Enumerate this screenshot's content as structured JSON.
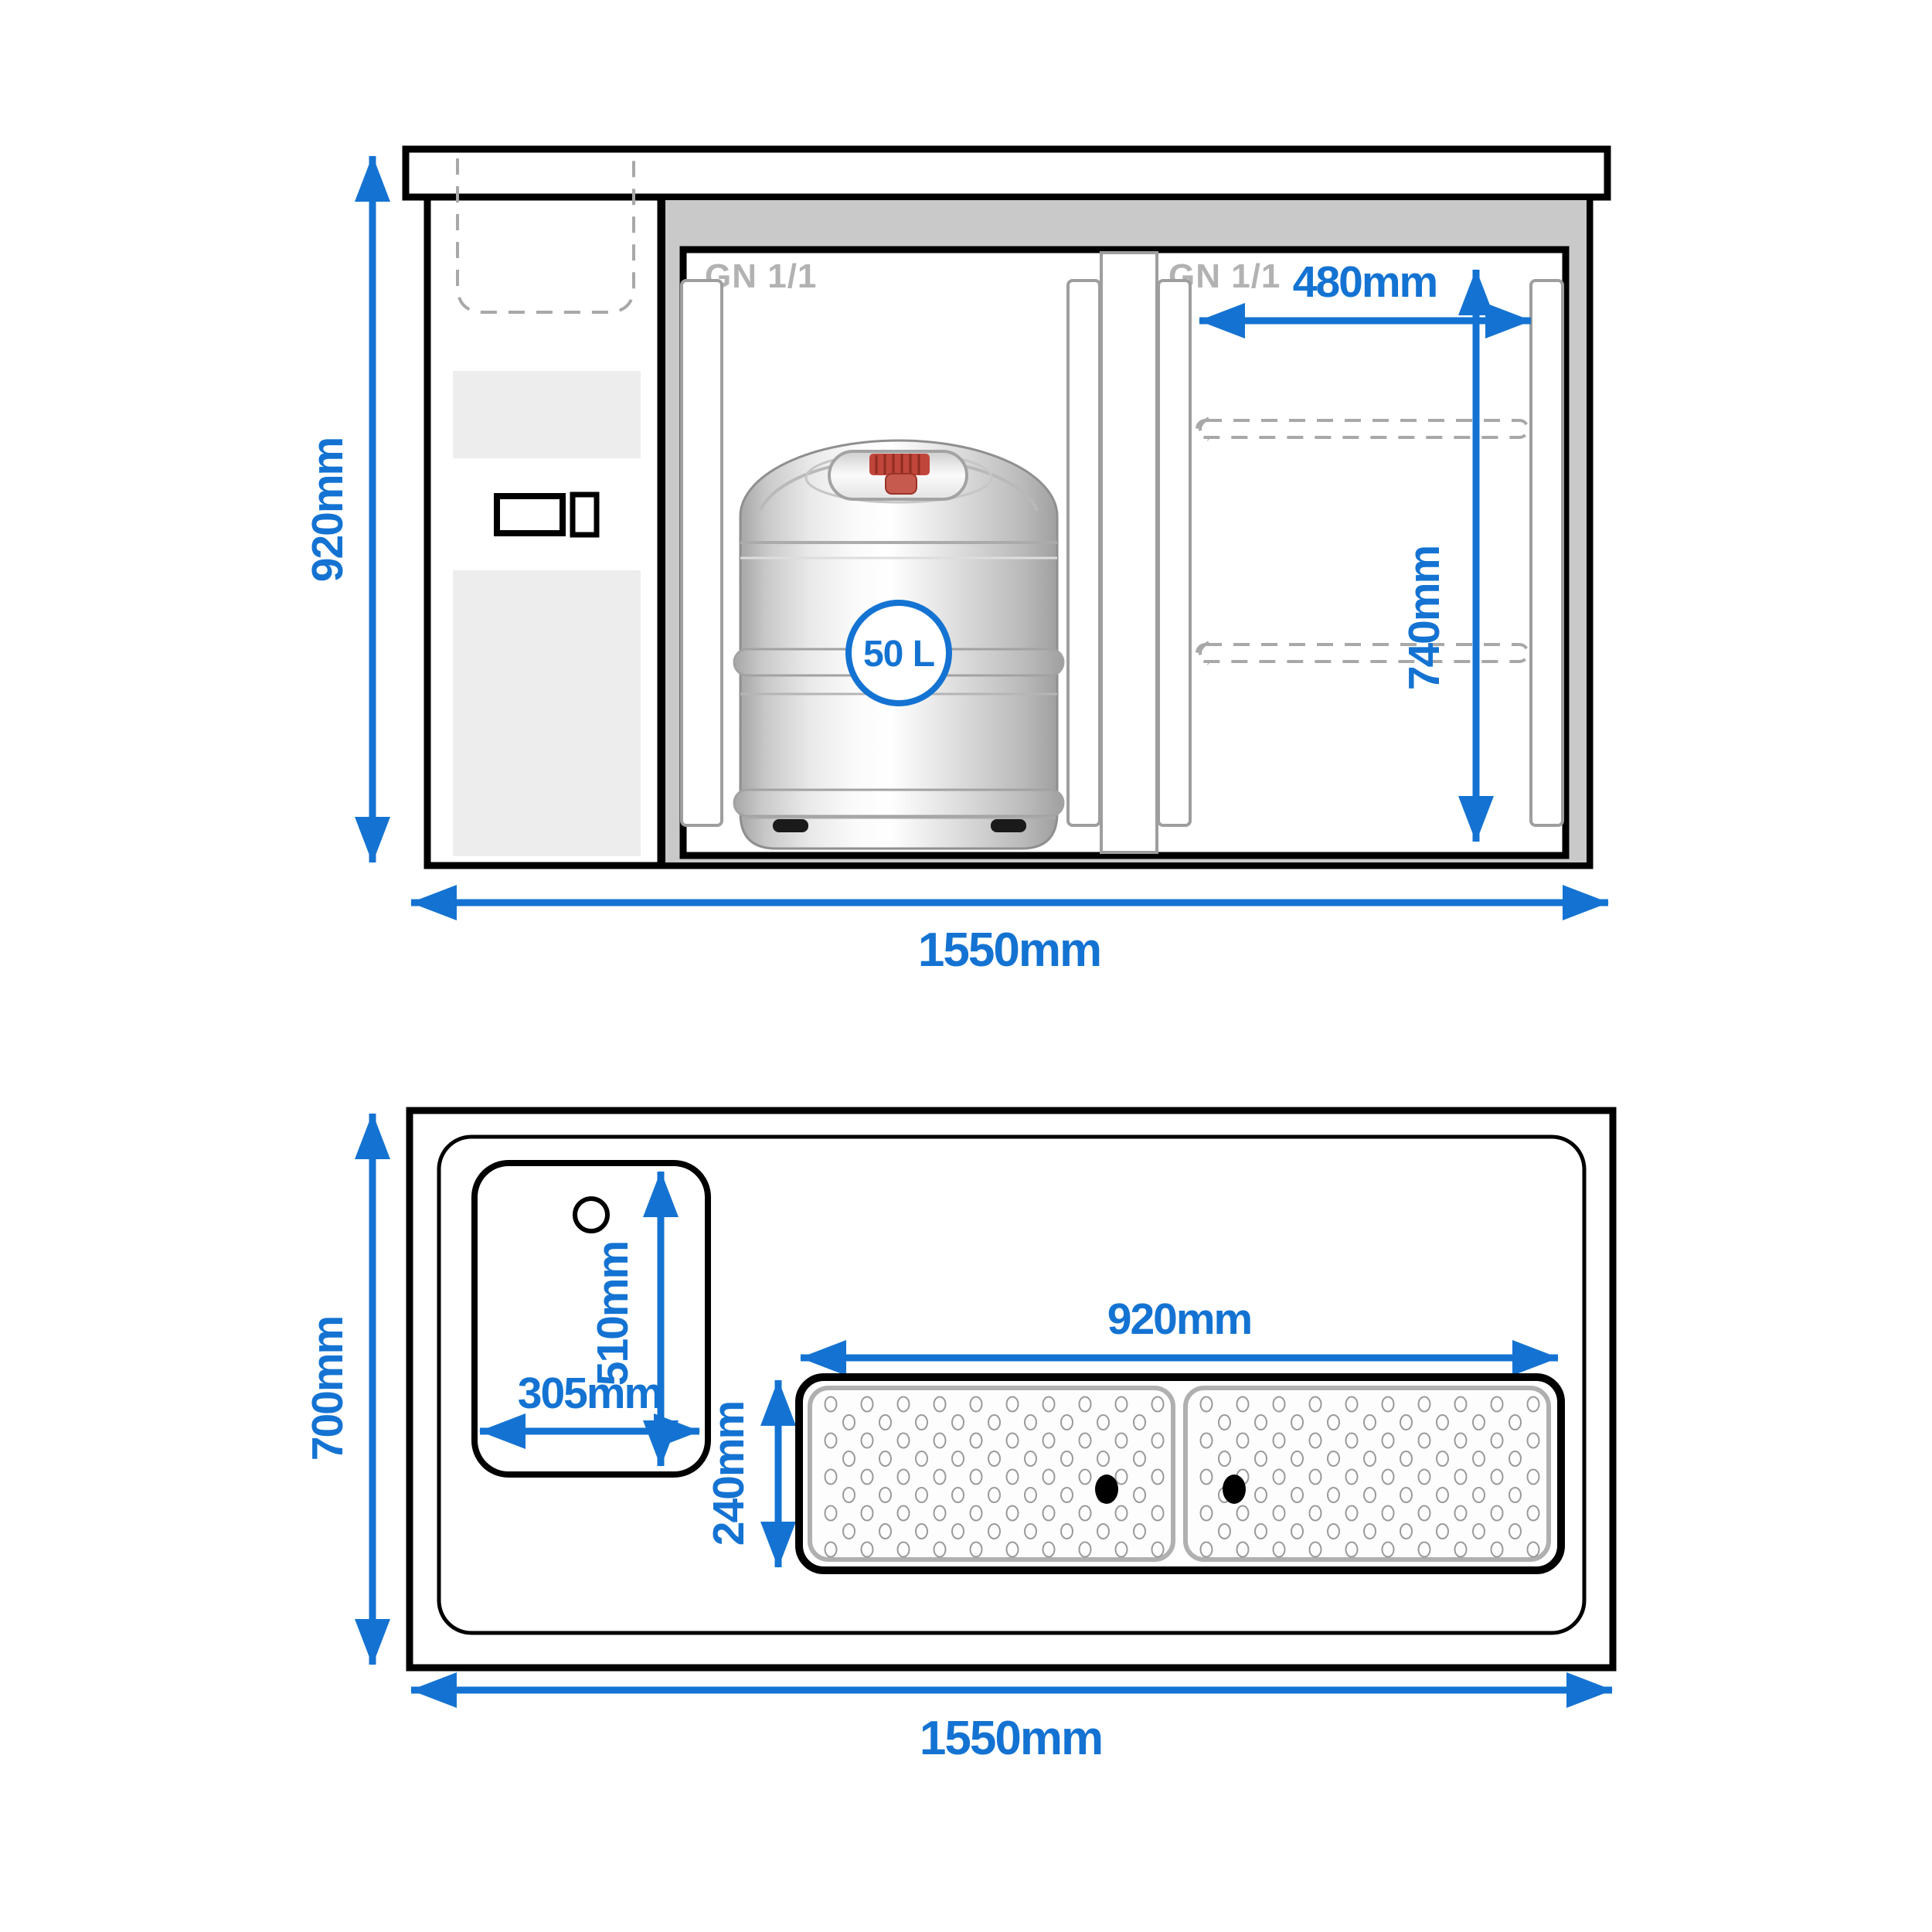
{
  "drawing_title": "Beer counter with keg cooler - dimensioned drawing",
  "colors": {
    "dimension_blue": "#1473d2",
    "line_black": "#000000",
    "cooler_frame_gray": "#c9c9c9",
    "gn_label_gray": "#b2b2b2",
    "rail_gray": "#9e9e9e",
    "dashed_gray": "#a8a8a8",
    "panel_gray": "#ededed",
    "tray_border_gray": "#b0b0b0",
    "keg_cap_red": "#c0453a"
  },
  "front_view": {
    "gn_label_left": "GN 1/1",
    "gn_label_right": "GN 1/1",
    "keg_badge": "50 L",
    "dim_total_height": "920mm",
    "dim_total_width": "1550mm",
    "dim_clear_width": "480mm",
    "dim_interior_height": "740mm"
  },
  "top_view": {
    "dim_total_depth": "700mm",
    "dim_total_width": "1550mm",
    "dim_sink_width": "305mm",
    "dim_sink_length": "510mm",
    "dim_trays_width": "920mm",
    "dim_tray_depth": "240mm"
  }
}
